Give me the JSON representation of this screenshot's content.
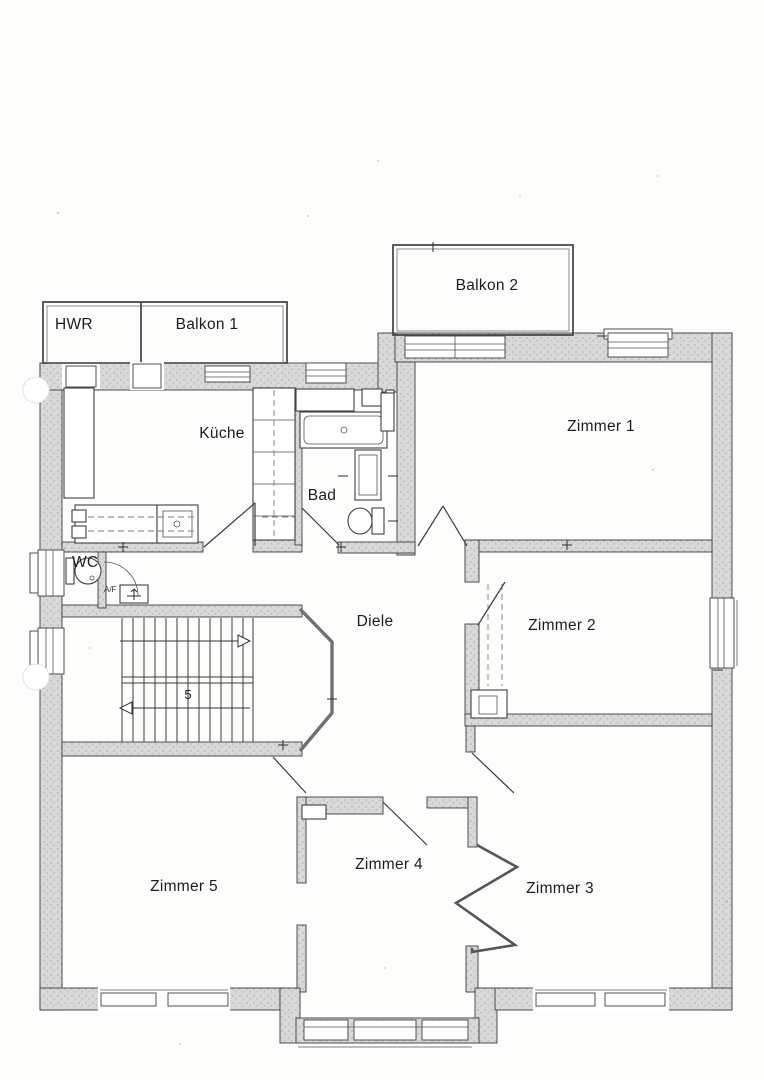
{
  "labels": {
    "hwr": "HWR",
    "balkon1": "Balkon 1",
    "balkon2": "Balkon 2",
    "kueche": "Küche",
    "bad": "Bad",
    "wc": "WC",
    "diele": "Diele",
    "zimmer1": "Zimmer 1",
    "zimmer2": "Zimmer 2",
    "zimmer3": "Zimmer 3",
    "zimmer4": "Zimmer 4",
    "zimmer5": "Zimmer 5",
    "stair_flight_number": "5",
    "vent_label": "A/F"
  },
  "colors": {
    "wall_fill": "#d9d9d9",
    "wall_speckle": "#ababab",
    "line": "#2e2e2e",
    "paper": "#fdfdfc"
  }
}
